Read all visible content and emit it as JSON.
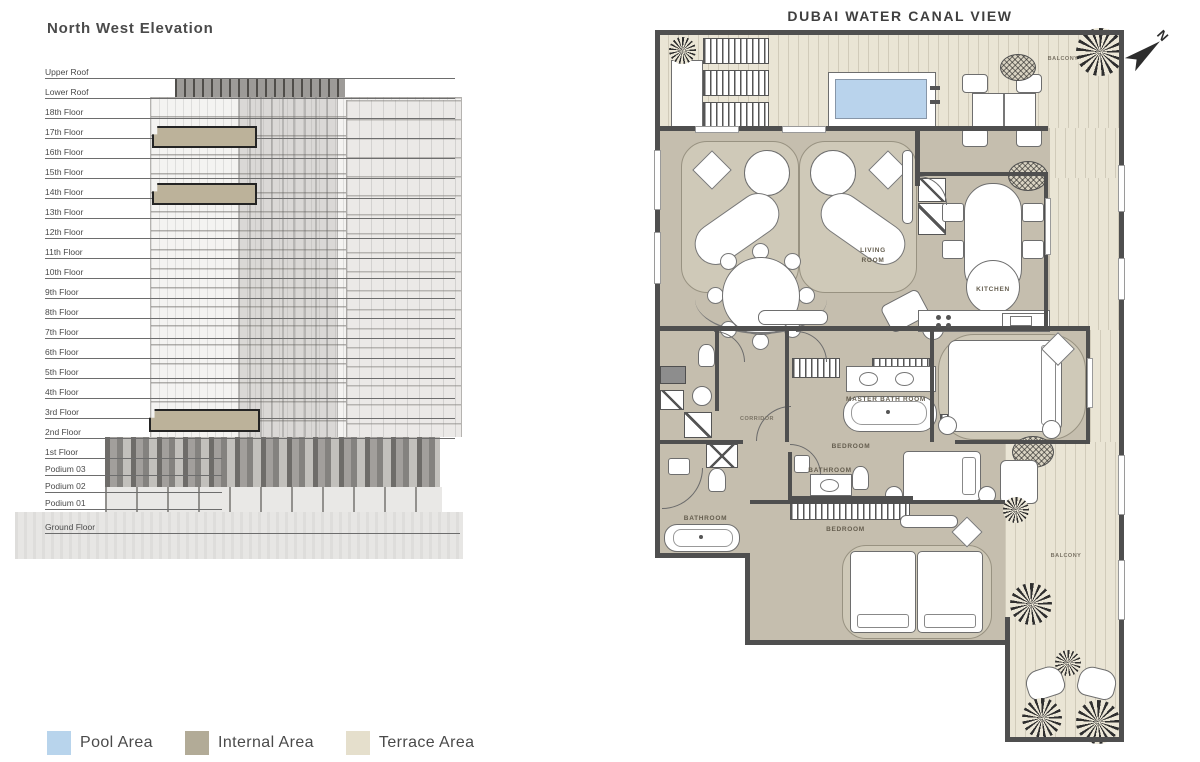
{
  "elevation": {
    "title": "North West Elevation",
    "floors": [
      {
        "label": "Upper Roof",
        "kind": "roof"
      },
      {
        "label": "Lower Roof",
        "kind": "roof"
      },
      {
        "label": "18th Floor",
        "kind": "floor"
      },
      {
        "label": "17th Floor",
        "kind": "floor",
        "highlighted": true
      },
      {
        "label": "16th Floor",
        "kind": "floor"
      },
      {
        "label": "15th Floor",
        "kind": "floor"
      },
      {
        "label": "14th Floor",
        "kind": "floor",
        "highlighted": true
      },
      {
        "label": "13th Floor",
        "kind": "floor"
      },
      {
        "label": "12th Floor",
        "kind": "floor"
      },
      {
        "label": "11th Floor",
        "kind": "floor"
      },
      {
        "label": "10th Floor",
        "kind": "floor"
      },
      {
        "label": "9th Floor",
        "kind": "floor"
      },
      {
        "label": "8th Floor",
        "kind": "floor"
      },
      {
        "label": "7th Floor",
        "kind": "floor"
      },
      {
        "label": "6th Floor",
        "kind": "floor"
      },
      {
        "label": "5th Floor",
        "kind": "floor"
      },
      {
        "label": "4th Floor",
        "kind": "floor"
      },
      {
        "label": "3rd Floor",
        "kind": "floor"
      },
      {
        "label": "2nd Floor",
        "kind": "floor",
        "highlighted": true
      },
      {
        "label": "1st Floor",
        "kind": "floor1"
      },
      {
        "label": "Podium 03",
        "kind": "podium"
      },
      {
        "label": "Podium 02",
        "kind": "podium"
      },
      {
        "label": "Podium 01",
        "kind": "podium"
      },
      {
        "label": "Ground Floor",
        "kind": "ground"
      }
    ]
  },
  "floorplan": {
    "title": "DUBAI WATER CANAL VIEW",
    "compass_label": "N",
    "labels": {
      "living_room": "LIVING ROOM",
      "kitchen": "KITCHEN",
      "master_bathroom": "MASTER BATH ROOM",
      "bedroom_1": "BEDROOM",
      "bathroom_1": "BATHROOM",
      "bedroom_2": "BEDROOM",
      "bathroom_2": "BATHROOM",
      "corridor": "CORRIDOR",
      "balcony_top": "BALCONY",
      "balcony_right": "BALCONY"
    },
    "colors": {
      "pool": "#b9d3ec",
      "internal": "#c5beae",
      "terrace": "#eae5d5",
      "wall": "#4f4f4f"
    }
  },
  "legend": {
    "items": [
      {
        "label": "Pool Area",
        "color": "#b8d4ec"
      },
      {
        "label": "Internal Area",
        "color": "#b2ab97"
      },
      {
        "label": "Terrace Area",
        "color": "#e5dfcc"
      }
    ]
  }
}
